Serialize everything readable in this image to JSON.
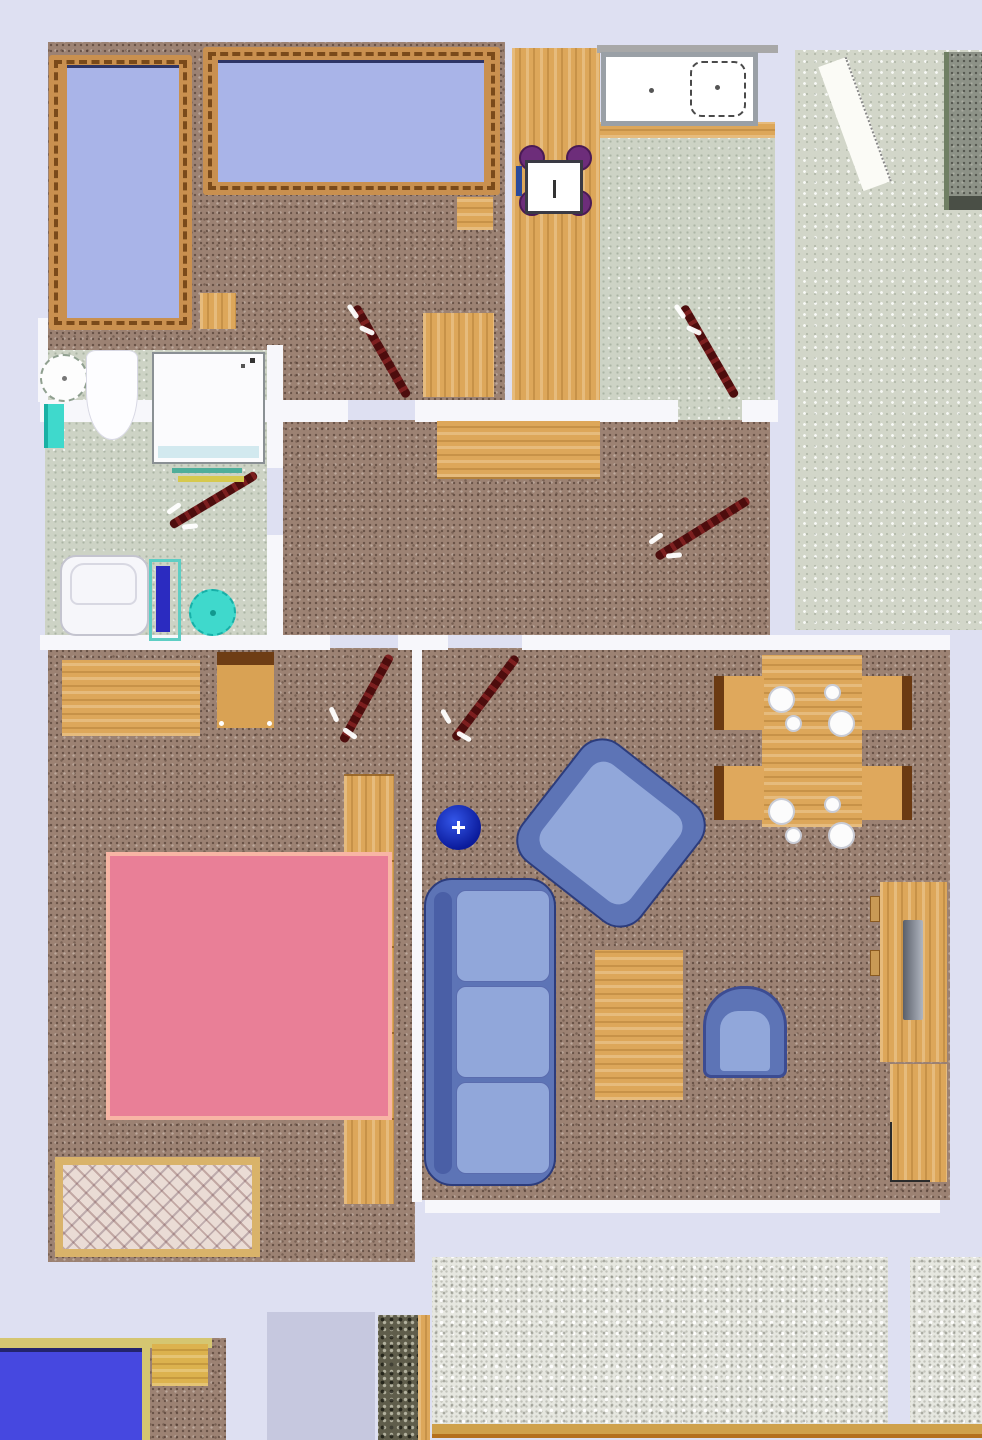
{
  "app": {
    "type": "apartment-floor-plan",
    "description": "Top-down 2D floor plan render of an apartment; no text labels visible anywhere in the image"
  },
  "palette": {
    "bg": "#dee0f2",
    "wall": "#f7f7fb",
    "carpet": "#9c8273",
    "tile": "#cdd3c5",
    "terrace": "#d2d6c9",
    "gravel": "#e6e7e0",
    "pebble": "#5f5d4b",
    "wood": "#dda75a",
    "wood_dark": "#b5823c",
    "frame": "#c9904f",
    "bed_blue": "#a9b4e8",
    "bed_navy": "#2e3566",
    "pink": "#e97f97",
    "pink_border": "#f8b5a5",
    "blue_bright": "#4648e0",
    "sofa": "#5d74b6",
    "cushion": "#91a7da",
    "sofa_edge": "#2c3c7c",
    "door": "#4d0d0d",
    "door_hi": "#7c1f1f",
    "purple": "#6d2d7a",
    "turquoise": "#3fd9cc",
    "mat_blue": "#2b2bc0",
    "tv_gray": "#6e7480",
    "sink_border": "#9aa0a6",
    "tan": "#d5c671",
    "rug_border": "#d9b36a"
  },
  "rooms": [
    {
      "name": "bedroom-top-left",
      "floor": "brown-carpet",
      "contents": [
        "two single beds with wood frames",
        "two nightstands",
        "side table",
        "door"
      ]
    },
    {
      "name": "kitchen",
      "floor": "green-tile",
      "contents": [
        "wood counter",
        "double sink unit",
        "small table with four purple stools",
        "door"
      ]
    },
    {
      "name": "balcony-upper-right",
      "floor": "speckled-stone",
      "contents": [
        "white bench",
        "dark doormat"
      ]
    },
    {
      "name": "bathroom",
      "floor": "green-tile",
      "contents": [
        "round washbasin",
        "toilet",
        "shower cabin",
        "towel bars",
        "bathtub",
        "blue bath mat",
        "turquoise stool",
        "door"
      ]
    },
    {
      "name": "hallway",
      "floor": "brown-carpet",
      "contents": [
        "wood sideboard",
        "door"
      ]
    },
    {
      "name": "bedroom-bottom-left",
      "floor": "brown-carpet",
      "contents": [
        "desk",
        "chair",
        "wardrobe",
        "pink double bed",
        "patterned rug",
        "door"
      ]
    },
    {
      "name": "living-room",
      "floor": "brown-carpet",
      "contents": [
        "dining table with four chairs and place settings",
        "rotated armchair",
        "blue round stool",
        "three-seat sofa",
        "coffee table",
        "small armchair",
        "tv sideboard with tv",
        "cabinet",
        "door"
      ]
    },
    {
      "name": "terrace-bottom",
      "floor": "white-gravel",
      "contents": [
        "wood edging"
      ]
    },
    {
      "name": "neighbor-room-bottom-left",
      "floor": "brown-carpet",
      "contents": [
        "blue bed",
        "nightstand"
      ]
    },
    {
      "name": "neighbor-room-bottom-middle",
      "floor": "plain-gray-lavender",
      "contents": []
    }
  ],
  "door_count": 6,
  "door_style": "dark-red diagonal leaf with white hinge ticks"
}
